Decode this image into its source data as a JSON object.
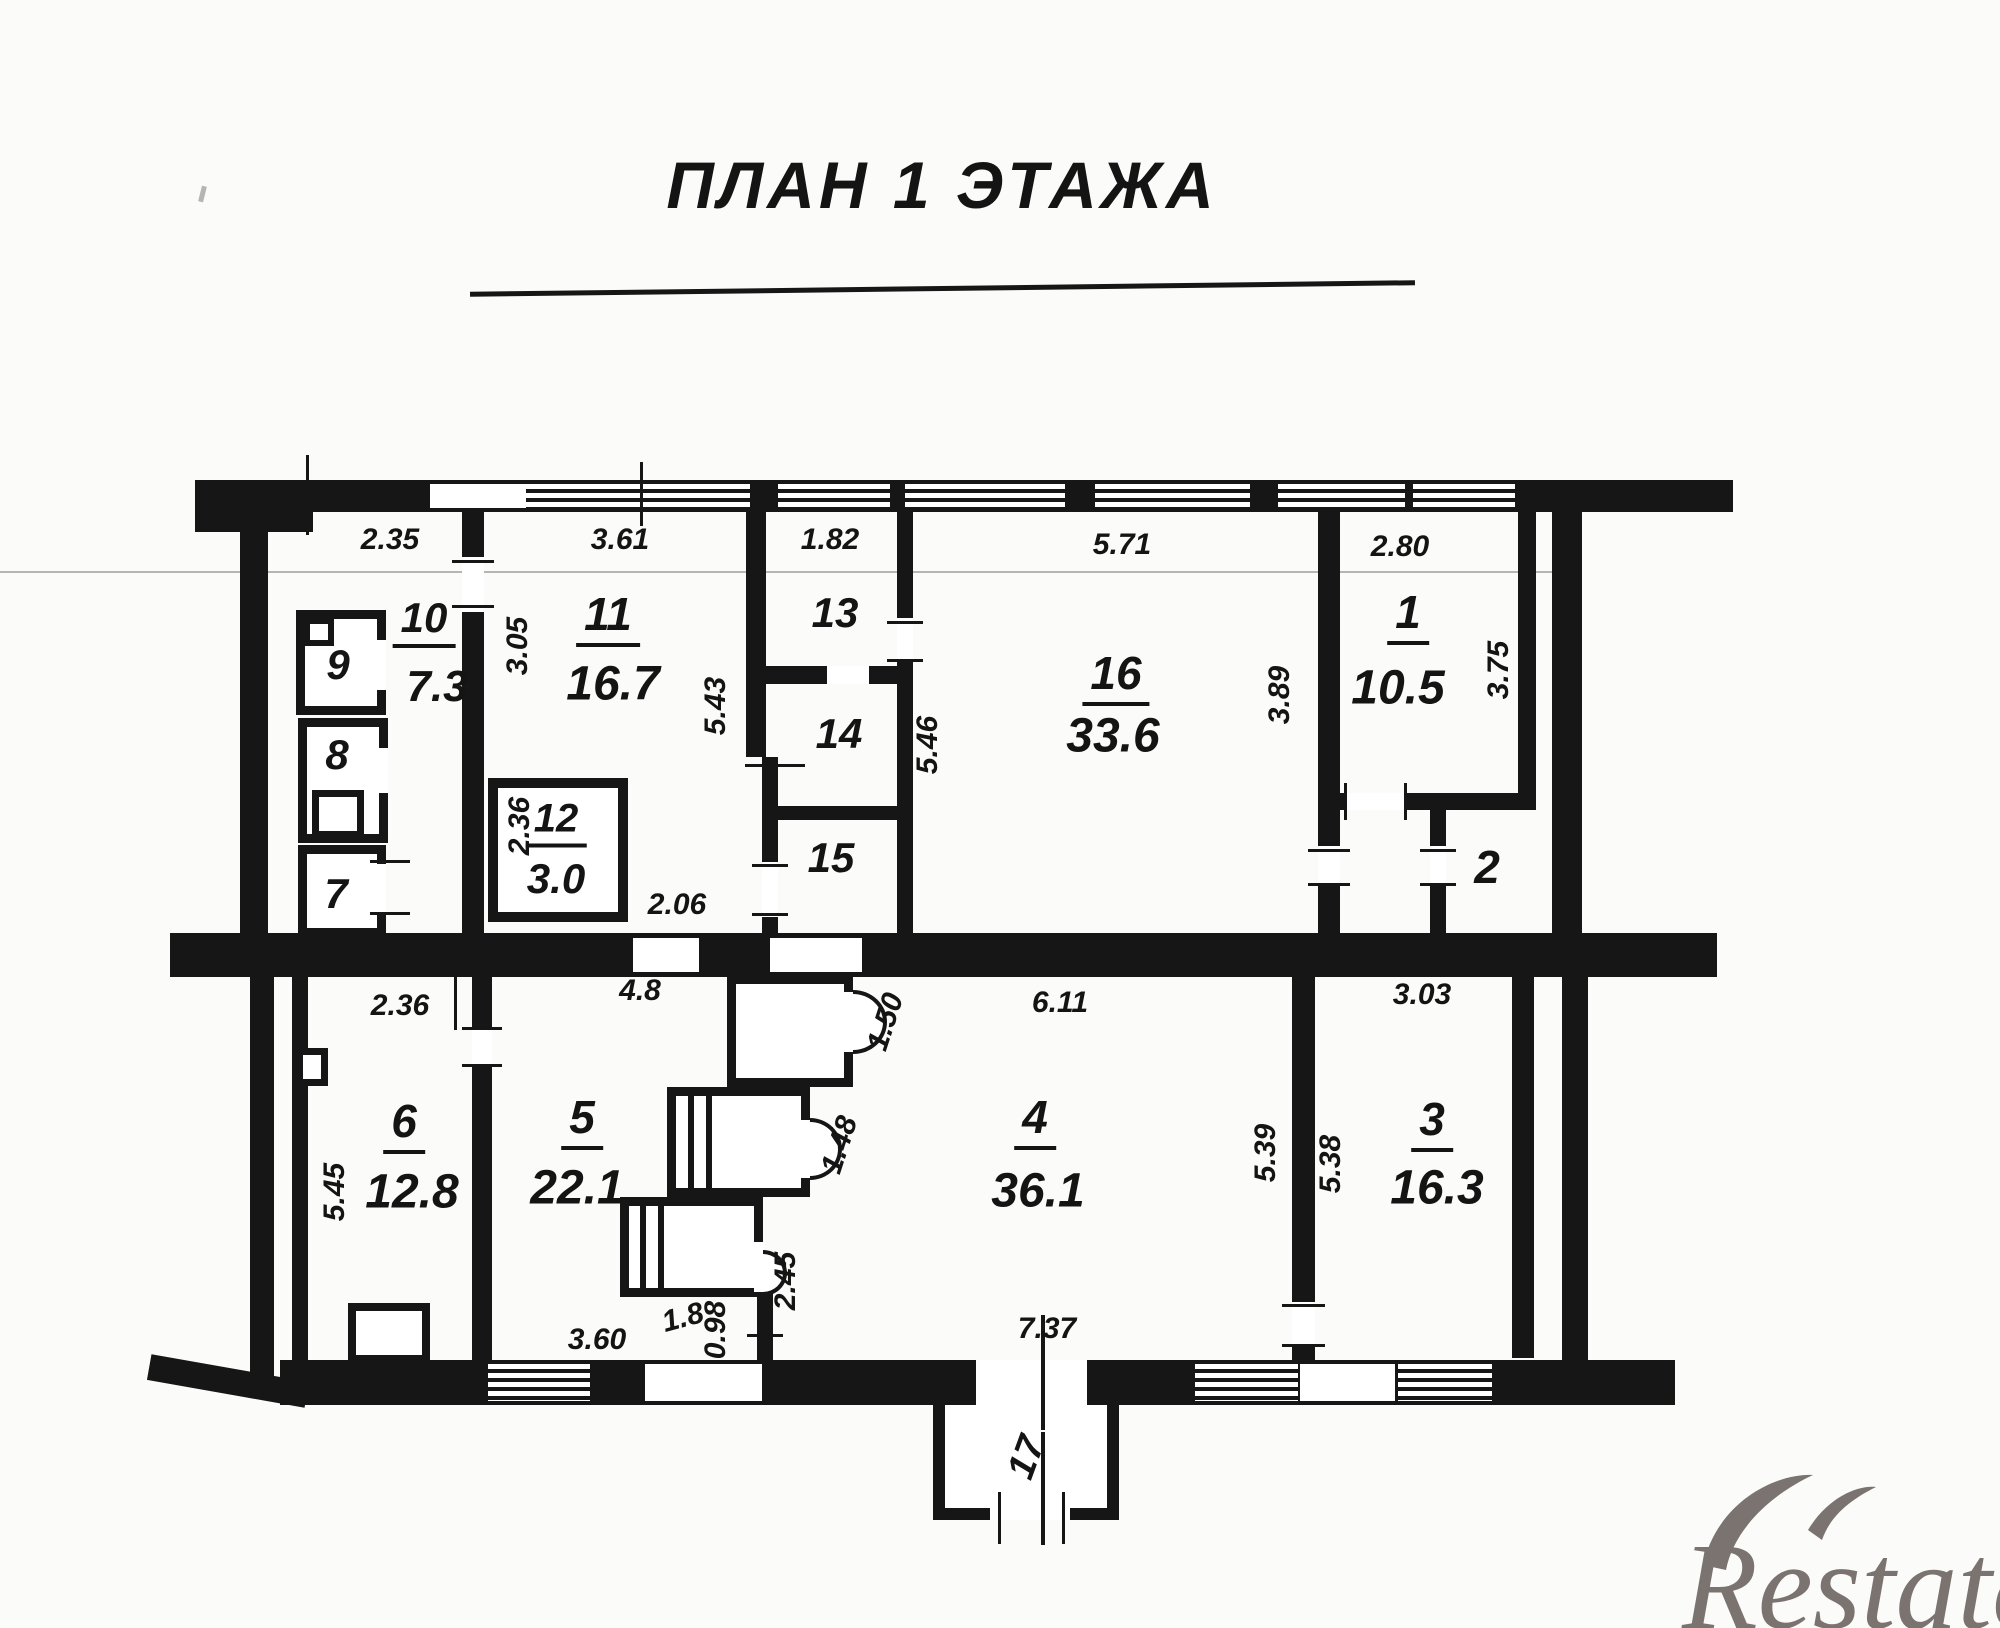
{
  "title": "ПЛАН 1 ЭТАЖА",
  "watermark": "Restate",
  "rooms": [
    {
      "n": "1",
      "a": "10.5"
    },
    {
      "n": "2",
      "a": ""
    },
    {
      "n": "3",
      "a": "16.3"
    },
    {
      "n": "4",
      "a": "36.1"
    },
    {
      "n": "5",
      "a": "22.1"
    },
    {
      "n": "6",
      "a": "12.8"
    },
    {
      "n": "7",
      "a": ""
    },
    {
      "n": "8",
      "a": ""
    },
    {
      "n": "9",
      "a": ""
    },
    {
      "n": "10",
      "a": "7.3"
    },
    {
      "n": "11",
      "a": "16.7"
    },
    {
      "n": "12",
      "a": "3.0"
    },
    {
      "n": "13",
      "a": ""
    },
    {
      "n": "14",
      "a": ""
    },
    {
      "n": "15",
      "a": ""
    },
    {
      "n": "16",
      "a": "33.6"
    },
    {
      "n": "17",
      "a": ""
    }
  ],
  "dims": [
    "2.35",
    "3.61",
    "1.82",
    "5.71",
    "2.80",
    "3.05",
    "5.43",
    "5.46",
    "3.89",
    "3.75",
    "2.36",
    "2.06",
    "2.36",
    "4.8",
    "6.11",
    "3.03",
    "5.45",
    "5.39",
    "5.38",
    "1.50",
    "1.48",
    "2.45",
    "1.8",
    "0.98",
    "3.60",
    "7.37"
  ]
}
